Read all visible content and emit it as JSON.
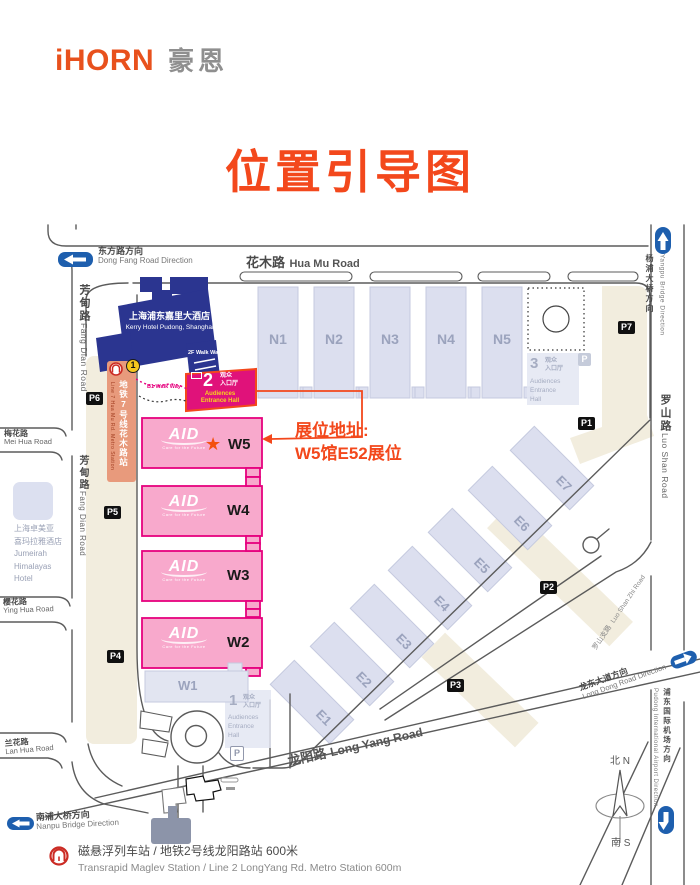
{
  "header": {
    "logo_en": "iHORN",
    "logo_cn": "豪恩",
    "title": "位置引导图"
  },
  "annotation": {
    "line1": "展位地址:",
    "line2": "W5馆E52展位",
    "star": "★"
  },
  "halls": {
    "north": [
      "N1",
      "N2",
      "N3",
      "N4",
      "N5"
    ],
    "west": [
      "W5",
      "W4",
      "W3",
      "W2"
    ],
    "west_small": "W1",
    "east": [
      "E1",
      "E2",
      "E3",
      "E4",
      "E5",
      "E6",
      "E7"
    ]
  },
  "aid_logo": {
    "name": "AID",
    "tagline": "Care for the Future"
  },
  "roads": {
    "hua_mu_cn": "花木路",
    "hua_mu_en": "Hua Mu Road",
    "fang_dian_cn": "芳甸路",
    "fang_dian_en": "Fang Dian Road",
    "mei_hua_cn": "梅花路",
    "mei_hua_en": "Mei Hua Road",
    "ying_hua_cn": "樱花路",
    "ying_hua_en": "Ying Hua Road",
    "lan_hua_cn": "兰花路",
    "lan_hua_en": "Lan Hua Road",
    "long_yang_cn": "龙阳路",
    "long_yang_en": "Long Yang Road",
    "luo_shan_cn": "罗山路",
    "luo_shan_en": "Luo Shan Road",
    "luo_shan_zhi_cn": "罗山支路",
    "luo_shan_zhi_en": "Luo Shan Zhi Road"
  },
  "directions": {
    "dong_fang_cn": "东方路方向",
    "dong_fang_en": "Dong Fang Road Direction",
    "yangpu_cn": "杨浦大桥方向",
    "yangpu_en": "Yangpu Bridge Direction",
    "nanpu_cn": "南浦大桥方向",
    "nanpu_en": "Nanpu Bridge Direction",
    "long_dong_cn": "龙东大道方向",
    "long_dong_en": "Long Dong Road Direction",
    "airport_cn": "浦东国际机场方向",
    "airport_en": "Pudong International Airport Direction"
  },
  "entrances": {
    "e1": {
      "num": "1",
      "cn1": "观众",
      "cn2": "入口厅",
      "en": [
        "Audiences",
        "Entrance",
        "Hall"
      ]
    },
    "e2": {
      "num": "2",
      "cn1": "观众",
      "cn2": "入口厅",
      "en1": "Audiences",
      "en2": "Entrance Hall"
    },
    "e3": {
      "num": "3",
      "cn1": "观众",
      "cn2": "入口厅",
      "en": [
        "Audiences",
        "Entrance",
        "Hall"
      ]
    }
  },
  "parking": {
    "labels": [
      "P1",
      "P2",
      "P3",
      "P4",
      "P5",
      "P6",
      "P7"
    ],
    "small": "P"
  },
  "metro": {
    "line7_cn": "地铁7号线花木路站",
    "line7_en": "Line 7 Hua Mu Rd. Metro Station",
    "sign_no": "1",
    "maglev_cn": "磁悬浮列车站 / 地铁2号线龙阳路站 600米",
    "maglev_en": "Transrapid Maglev Station / Line 2 LongYang Rd. Metro Station   600m"
  },
  "buildings": {
    "kerry_cn": "上海浦东嘉里大酒店",
    "kerry_en": "Kerry Hotel Pudong, Shanghai",
    "jumeirah": [
      "上海卓美亚",
      "喜玛拉雅酒店",
      "Jumeirah",
      "Himalayas",
      "Hotel"
    ],
    "walkway_2f": "2F Walk Way",
    "walkway_b1": "B1 Walk Way"
  },
  "compass": {
    "north": "北 N",
    "south": "南 S"
  },
  "colors": {
    "brand_orange": "#F3481C",
    "hall_pink": "#F8A9CC",
    "pink_border": "#E6017E",
    "entrance_pink": "#E0127A",
    "hotel_blue": "#2B3590",
    "hall_gray": "#DCDFEF",
    "beige": "#F2EDDE",
    "salmon": "#E89A7C",
    "road_gray": "#5B5B5B",
    "arrow_blue": "#1E5FAE",
    "metro_red": "#CB2B24",
    "sign_yellow": "#F6C71E"
  }
}
